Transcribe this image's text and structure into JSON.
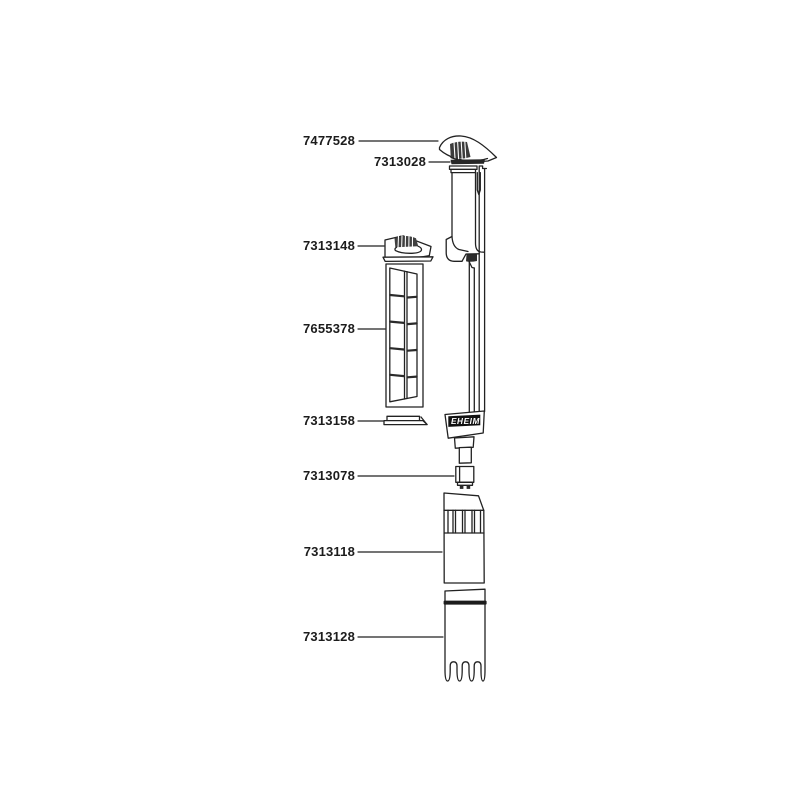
{
  "colors": {
    "background": "#ffffff",
    "ink": "#222222",
    "logo_background": "#111111",
    "logo_text": "#ffffff"
  },
  "diagram": {
    "brand": "EHEIM",
    "labels": [
      {
        "part_number": "7477528"
      },
      {
        "part_number": "7313028"
      },
      {
        "part_number": "7313148"
      },
      {
        "part_number": "7655378"
      },
      {
        "part_number": "7313158"
      },
      {
        "part_number": "7313078"
      },
      {
        "part_number": "7313118"
      },
      {
        "part_number": "7313128"
      }
    ]
  }
}
